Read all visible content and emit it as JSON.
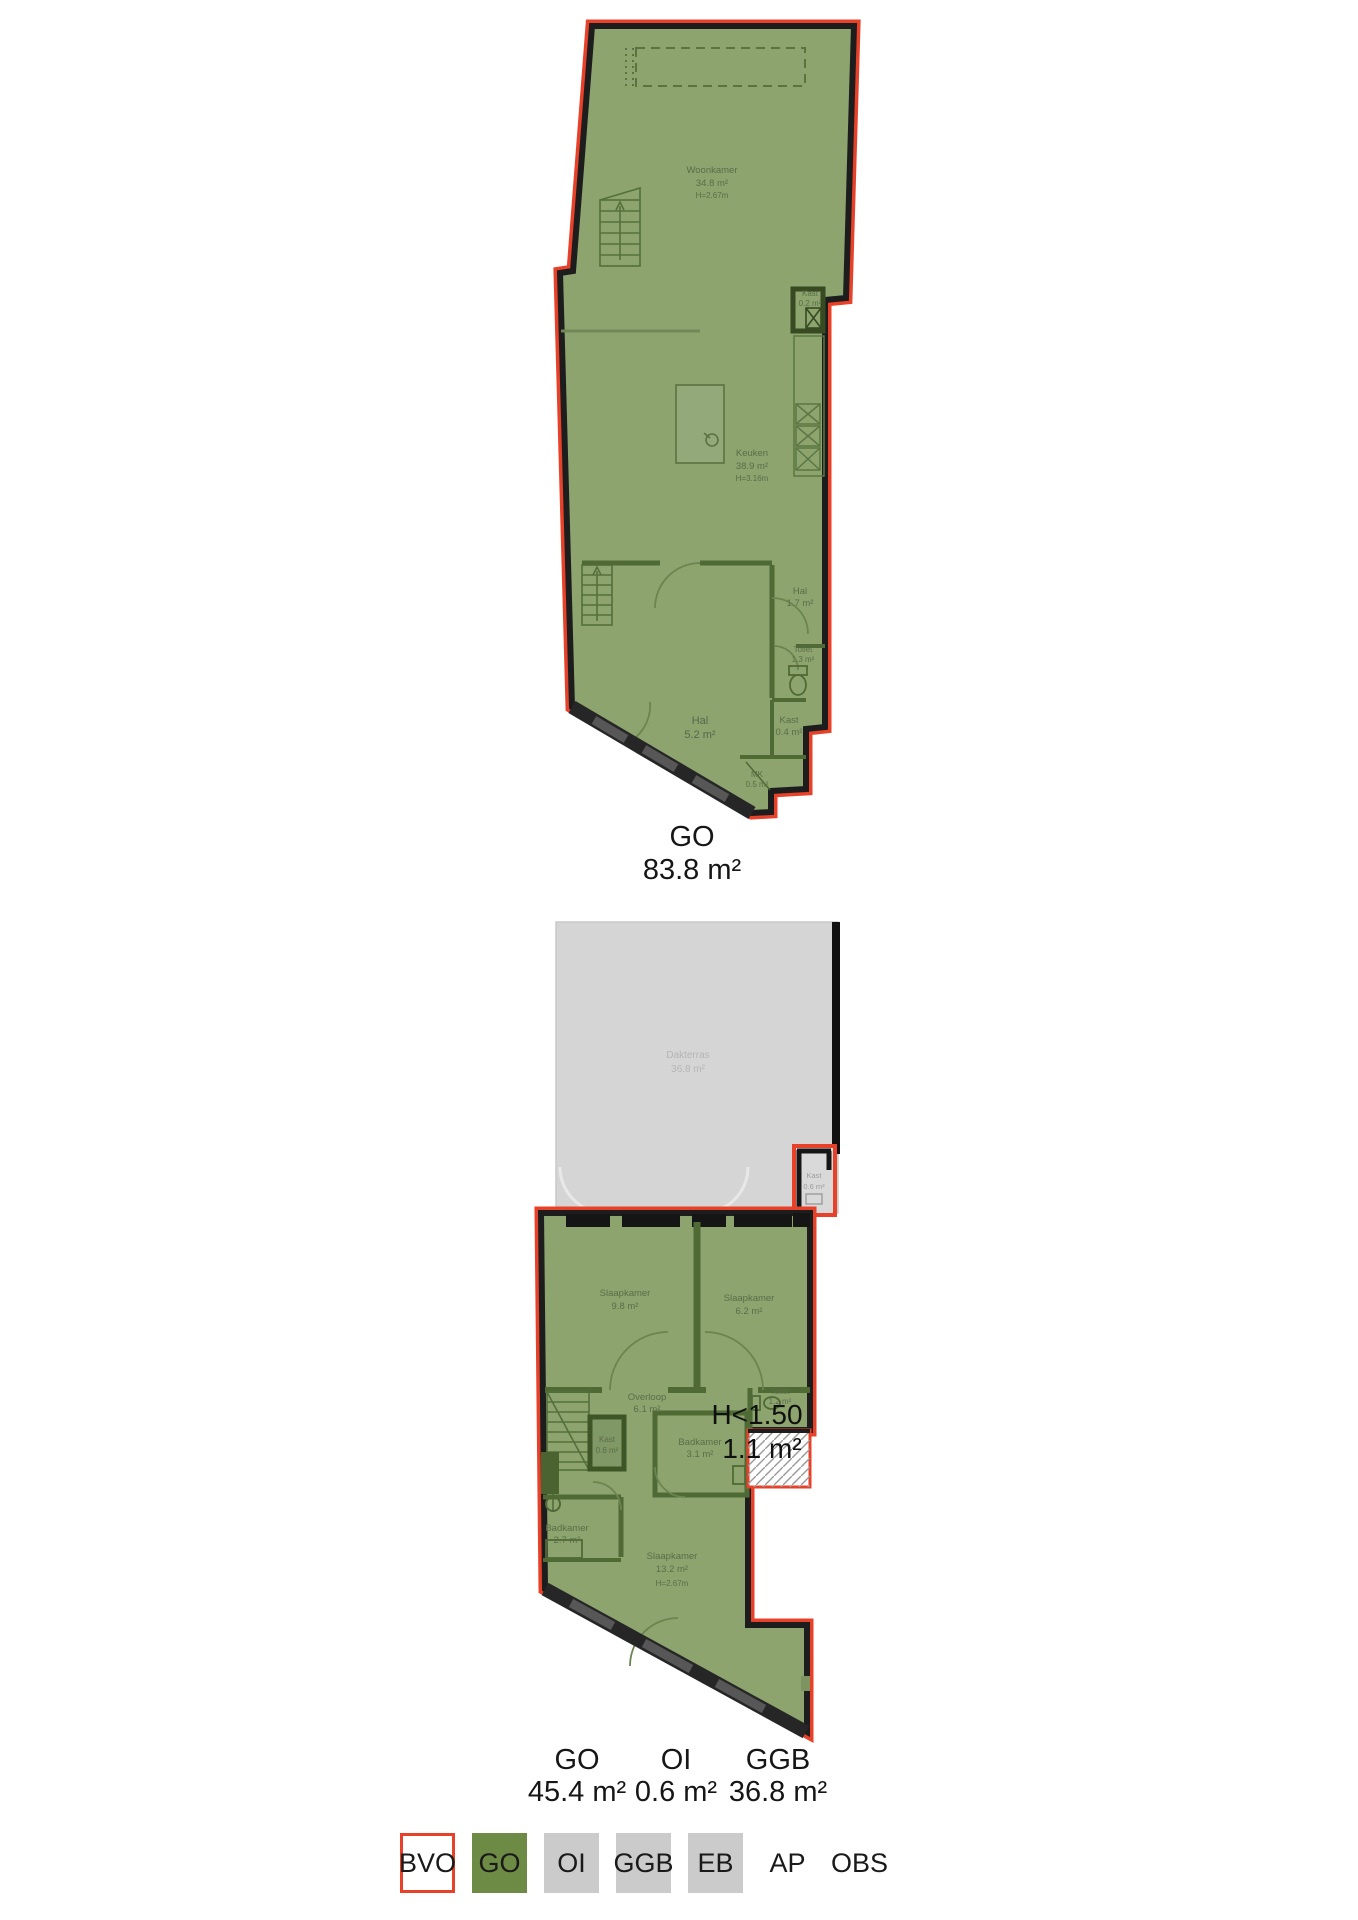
{
  "colors": {
    "outline_red": "#e8412a",
    "plan_green": "#8da46f",
    "wall_green": "#4f6a35",
    "wall_black": "#1d1d1d",
    "terrace_grey": "#d5d5d5",
    "legend_green": "#6e8b45",
    "legend_grey": "#cbcbcb"
  },
  "plan1": {
    "total": {
      "code": "GO",
      "area": "83.8 m²"
    },
    "rooms": {
      "woonkamer": {
        "name": "Woonkamer",
        "area": "34.8 m²",
        "height": "H=2.67m"
      },
      "keuken": {
        "name": "Keuken",
        "area": "38.9 m²",
        "height": "H=3.16m"
      },
      "kast": {
        "name": "Kast",
        "area": "0.2 m²"
      },
      "hal": {
        "name": "Hal",
        "area": "1.7 m²"
      },
      "toilet": {
        "name": "Toilet",
        "area": "1.3 m²"
      },
      "hal2": {
        "name": "Hal",
        "area": "5.2 m²"
      },
      "kast2": {
        "name": "Kast",
        "area": "0.4 m²"
      },
      "mk": {
        "name": "MK",
        "area": "0.5 m²"
      }
    }
  },
  "plan2": {
    "totals": [
      {
        "code": "GO",
        "area": "45.4 m²"
      },
      {
        "code": "OI",
        "area": "0.6 m²"
      },
      {
        "code": "GGB",
        "area": "36.8 m²"
      }
    ],
    "low_height": {
      "line1": "H<1.50",
      "line2": "1.1 m²"
    },
    "rooms": {
      "dakterras": {
        "name": "Dakterras",
        "area": "36.8 m²"
      },
      "kast_oi": {
        "name": "Kast",
        "area": "0.6 m²"
      },
      "slaapkamer1": {
        "name": "Slaapkamer",
        "area": "9.8 m²"
      },
      "slaapkamer2": {
        "name": "Slaapkamer",
        "area": "6.2 m²"
      },
      "overloop": {
        "name": "Overloop",
        "area": "6.1 m²"
      },
      "toilet": {
        "name": "Toilet",
        "area": "1.2 m²"
      },
      "kast": {
        "name": "Kast",
        "area": "0.6 m²"
      },
      "badkamer1": {
        "name": "Badkamer",
        "area": "3.1 m²"
      },
      "badkamer2": {
        "name": "Badkamer",
        "area": "2.7 m²"
      },
      "slaapkamer3": {
        "name": "Slaapkamer",
        "area": "13.2 m²",
        "height": "H=2.67m"
      }
    }
  },
  "legend": {
    "items": [
      {
        "label": "BVO",
        "color": "#ffffff",
        "boxed": true,
        "bordered": true
      },
      {
        "label": "GO",
        "color": "#6e8b45",
        "boxed": true
      },
      {
        "label": "OI",
        "color": "#cbcbcb",
        "boxed": true
      },
      {
        "label": "GGB",
        "color": "#cbcbcb",
        "boxed": true
      },
      {
        "label": "EB",
        "color": "#cbcbcb",
        "boxed": true
      },
      {
        "label": "AP",
        "boxed": false
      },
      {
        "label": "OBS",
        "boxed": false
      }
    ]
  }
}
